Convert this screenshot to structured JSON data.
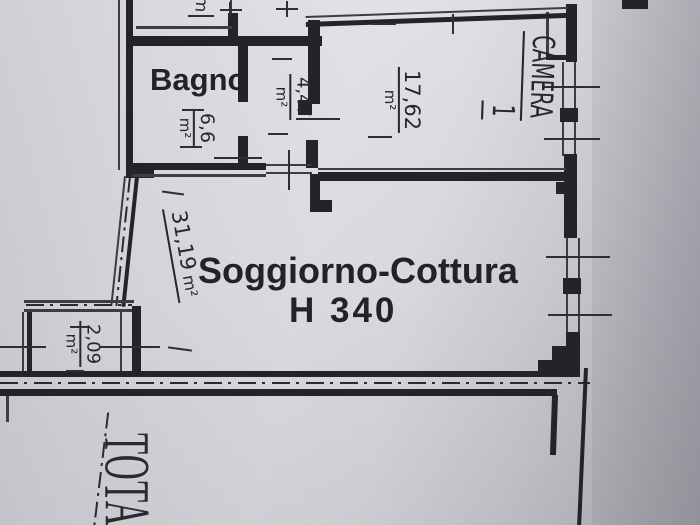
{
  "rooms": {
    "bagno": {
      "label": "Bagno",
      "area": "6,6",
      "unit": "m²"
    },
    "corridor": {
      "area": "4,47",
      "unit": "m²"
    },
    "camera": {
      "label": "CAMERA",
      "number": "1",
      "area": "17,62",
      "unit": "m²"
    },
    "soggiorno": {
      "label": "Soggiorno-Cottura",
      "height": "H 340",
      "area": "31,19",
      "unit": "m²"
    },
    "balcony": {
      "area": "2,09",
      "unit": "m²"
    },
    "upper": {
      "partial_label": "m"
    }
  },
  "footer": {
    "total_partial": "TOTA"
  },
  "colors": {
    "ink": "#232329",
    "paper": "#dcdbe1"
  }
}
